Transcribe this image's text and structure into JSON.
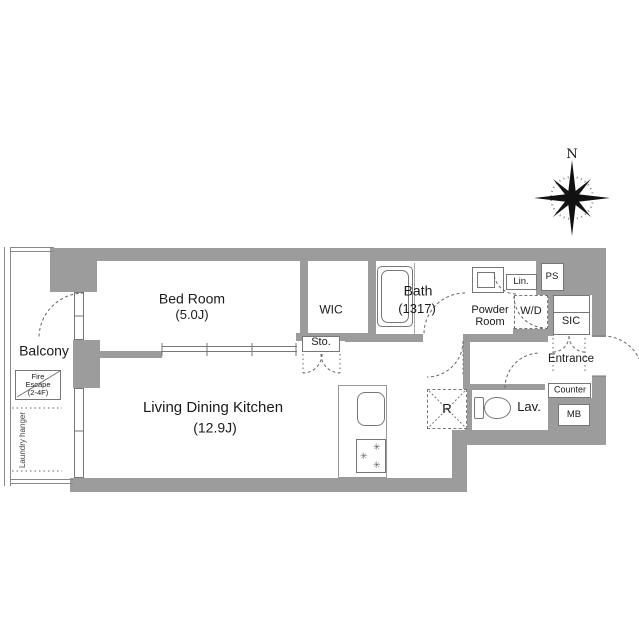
{
  "compass": {
    "north_label": "N"
  },
  "rooms": {
    "bedroom": {
      "name": "Bed Room",
      "size": "(5.0J)"
    },
    "ldk": {
      "name": "Living Dining Kitchen",
      "size": "(12.9J)"
    },
    "balcony": {
      "name": "Balcony"
    },
    "wic": {
      "name": "WIC"
    },
    "bath": {
      "name": "Bath",
      "size": "(1317)"
    },
    "powder_room": {
      "line1": "Powder",
      "line2": "Room"
    },
    "lavatory": {
      "name": "Lav."
    },
    "entrance": {
      "name": "Entrance"
    }
  },
  "labels": {
    "linen": "Lin.",
    "pipe_space": "PS",
    "washer_dryer": "W/D",
    "shoe_closet": "SIC",
    "storage": "Sto.",
    "counter": "Counter",
    "meter_box": "MB",
    "refrigerator": "R",
    "laundry_hanger": "Laundry hanger",
    "fire_escape": {
      "line1": "Fire",
      "line2": "Escape",
      "line3": "(2-4F)"
    }
  },
  "icons": {
    "burner": "✳"
  },
  "colors": {
    "wall": "#9c9c9c",
    "line": "#777777",
    "text": "#1a1a1a"
  }
}
